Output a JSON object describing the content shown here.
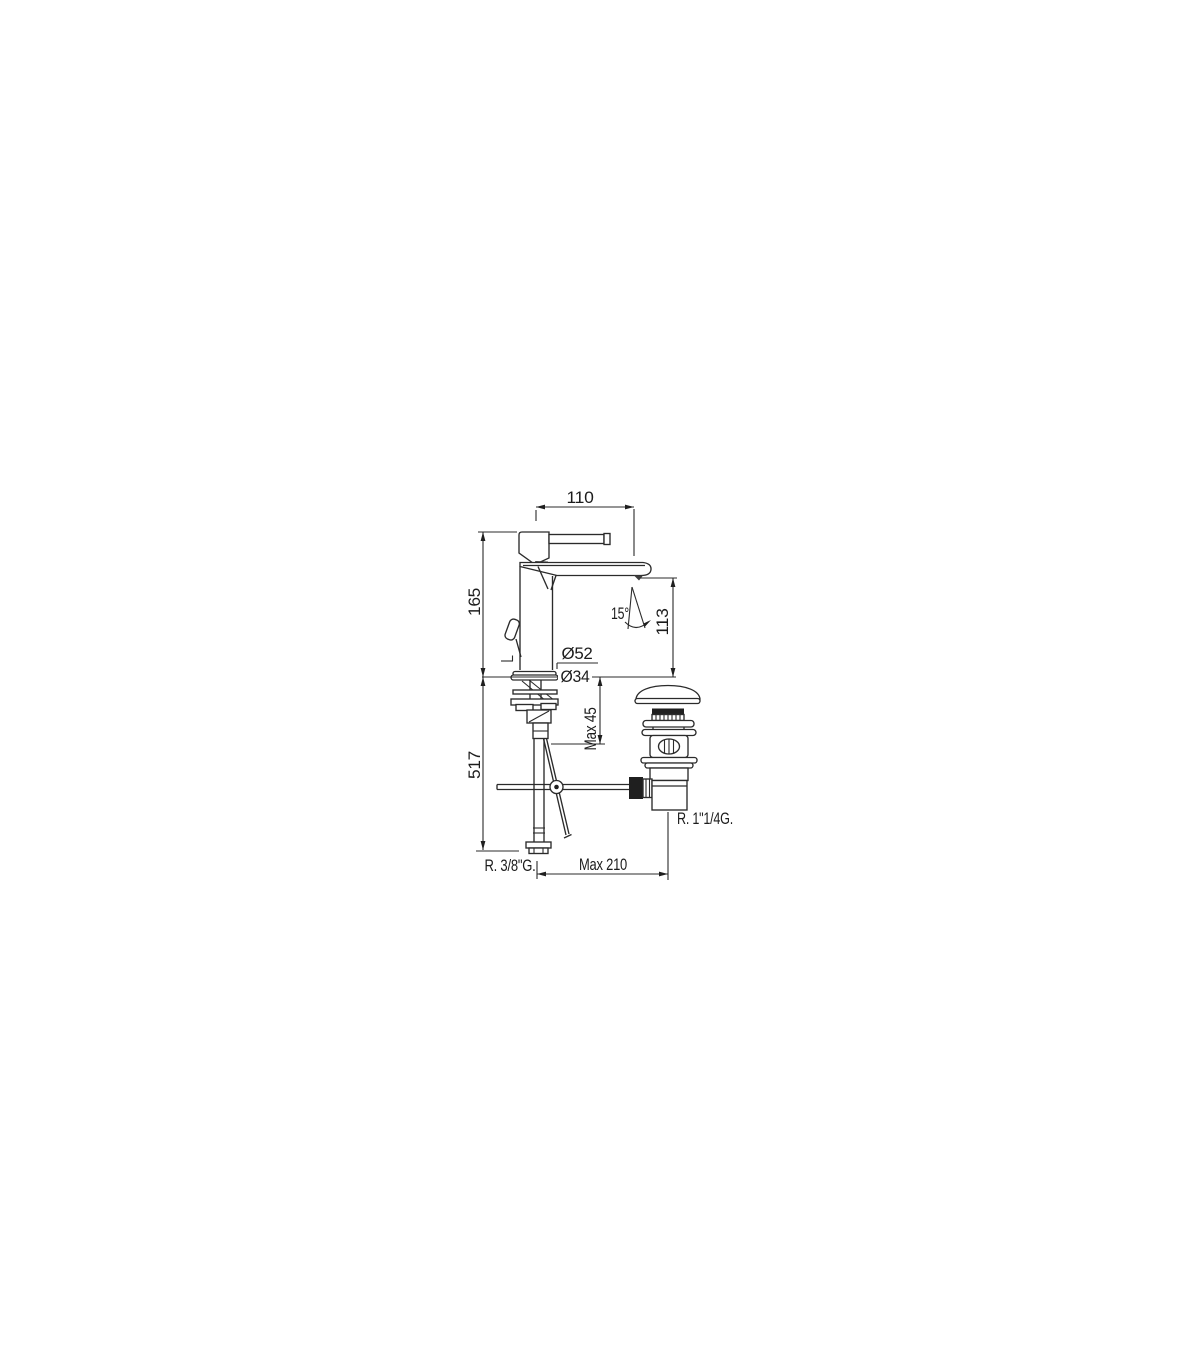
{
  "page": {
    "background": "#ffffff"
  },
  "drawing": {
    "title": "Basin mixer tap technical dimension drawing",
    "object": "single-lever basin mixer with pop-up waste drain",
    "line_color": "#2b2b2b",
    "dimensions": {
      "spout_projection_top": "110",
      "deck_to_top_height": "165",
      "spray_angle": "15°",
      "spout_outlet_height": "113",
      "base_diameter": "Ø52",
      "mounting_hole_diameter": "Ø34",
      "max_deck_thickness": "Max 45",
      "overall_height_with_hoses": "517",
      "waste_connection_thread": "R. 1\"1/4G.",
      "supply_hose_thread": "R. 3/8\"G.",
      "max_horizontal_reach": "Max 210"
    }
  }
}
